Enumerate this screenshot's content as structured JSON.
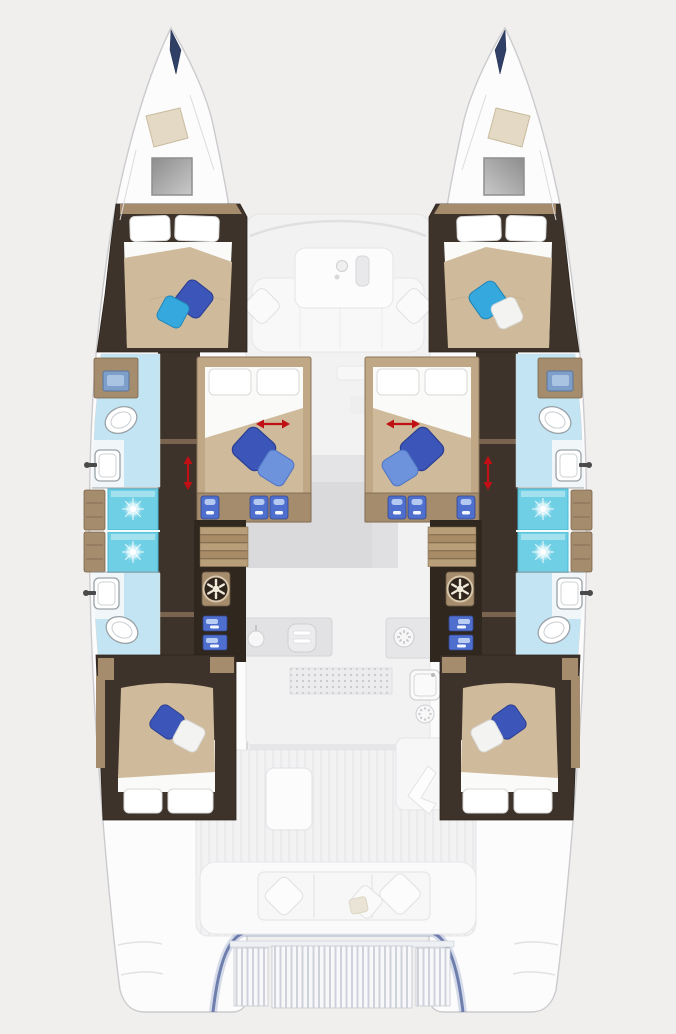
{
  "page": {
    "title": "Catamaran yacht interior floor plan (top-down, bow up)",
    "visible_text": "none"
  },
  "palette": {
    "bg": "#f0efee",
    "hull_fill": "#fcfcfc",
    "hull_stroke": "#cbcbce",
    "wall_dark": "#3e332a",
    "wall_darker": "#30271f",
    "wood": "#a58c6d",
    "wood_light": "#c0a887",
    "locker_beige": "#e3d9c4",
    "bed_sheet": "#fafaf8",
    "bed_blanket": "#cfba9b",
    "pillow_white": "#f3f3f2",
    "pillow_navy": "#3c55b8",
    "pillow_blue": "#6d93dd",
    "pillow_cyan": "#35a8de",
    "bath_floor": "#c3e5f3",
    "shower_cyan": "#6fcfe5",
    "fixture_stroke": "#9aa2a8",
    "drawer_blue": "#4f6fce",
    "arrow_red": "#c01015",
    "transom_blue": "#54689f",
    "grate_gap": "#cfd2da"
  },
  "plan": {
    "vessel": "sailing catamaran, two hulls, bows pointing up",
    "cabins": [
      {
        "id": "port-forward-cabin",
        "bed": "double, head forward",
        "throw_pillows": [
          "navy",
          "cyan"
        ]
      },
      {
        "id": "starboard-forward-cabin",
        "bed": "double, head forward",
        "throw_pillows": [
          "cyan",
          "white"
        ]
      },
      {
        "id": "port-midship-cabin",
        "bed": "double with red width arrow (convertible)",
        "throw_pillows": [
          "navy",
          "light-blue"
        ]
      },
      {
        "id": "starboard-midship-cabin",
        "bed": "double with red width arrow (convertible)",
        "throw_pillows": [
          "navy",
          "light-blue"
        ]
      },
      {
        "id": "port-aft-cabin",
        "bed": "double, head aft",
        "throw_pillows": [
          "navy",
          "white"
        ]
      },
      {
        "id": "starboard-aft-cabin",
        "bed": "double, head aft",
        "throw_pillows": [
          "navy",
          "white"
        ]
      }
    ],
    "bathrooms": [
      {
        "id": "port-forward-head",
        "fixtures": [
          "toilet",
          "sink",
          "vanity"
        ]
      },
      {
        "id": "port-aft-head",
        "fixtures": [
          "sink",
          "toilet"
        ]
      },
      {
        "id": "starboard-forward-head",
        "fixtures": [
          "toilet",
          "sink",
          "vanity"
        ]
      },
      {
        "id": "starboard-aft-head",
        "fixtures": [
          "sink",
          "toilet"
        ]
      }
    ],
    "showers": {
      "count": 4,
      "marker": "white starburst drain on cyan floor"
    },
    "symbols": {
      "red_horizontal_arrows": 2,
      "red_vertical_arrows": 2,
      "round_hatch_vents": 2,
      "blue_front_storage_steps": "under midship beds and beside companionways",
      "companionway_stairs": 2
    },
    "deck_areas": {
      "bow": [
        "anchor locker (beige)",
        "grey deck hatch",
        "dark bow fitting"
      ],
      "forward_cockpit": [
        "table with tray",
        "lounge bench",
        "2 white scatter cushions"
      ],
      "saloon_galley": [
        "grey dinette",
        "oven",
        "round sink",
        "burner",
        "dotted floor mat",
        "sink unit",
        "small burner"
      ],
      "aft_cockpit": [
        "table",
        "bench with 3 cushion sections",
        "3 scatter cushions",
        "helm seat"
      ],
      "transom": [
        "blue-edged swim platform",
        "teak grating in 3 sections"
      ]
    }
  }
}
